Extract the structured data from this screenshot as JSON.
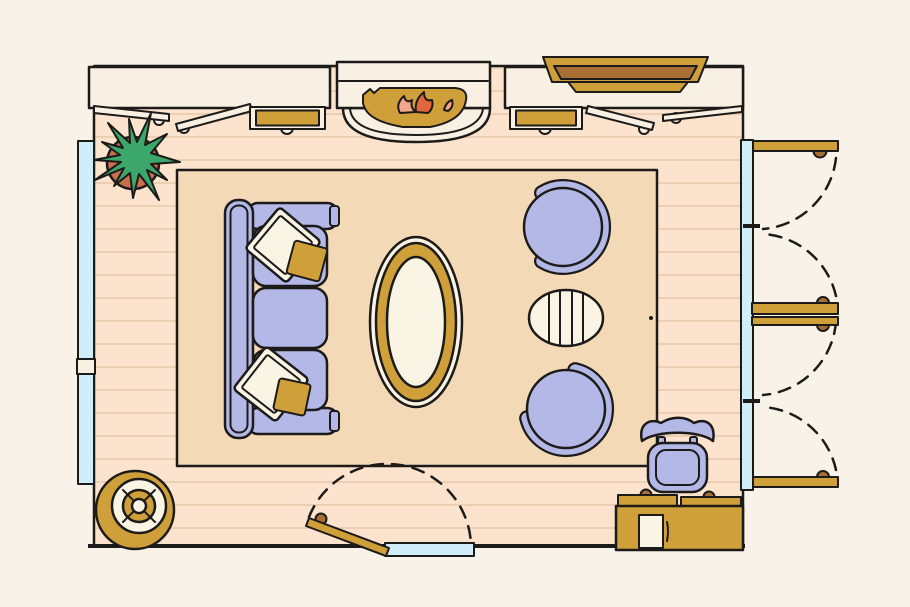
{
  "scene": {
    "type": "floor-plan-illustration",
    "room": "living-room",
    "items": [
      {
        "name": "wood-floor"
      },
      {
        "name": "area-rug"
      },
      {
        "name": "sofa",
        "pillows": 2
      },
      {
        "name": "throw-pillow-top"
      },
      {
        "name": "throw-pillow-bottom"
      },
      {
        "name": "oval-coffee-table"
      },
      {
        "name": "accent-chair-top"
      },
      {
        "name": "accent-chair-bottom"
      },
      {
        "name": "striped-ottoman"
      },
      {
        "name": "fireplace-with-fire"
      },
      {
        "name": "media-console-tv"
      },
      {
        "name": "side-cabinet-left"
      },
      {
        "name": "side-cabinet-right"
      },
      {
        "name": "open-casement-windows",
        "count": 4
      },
      {
        "name": "potted-plant"
      },
      {
        "name": "round-floor-lamp"
      },
      {
        "name": "desk-with-paper-and-pen"
      },
      {
        "name": "desk-chair"
      },
      {
        "name": "left-wall-windows",
        "count": 2
      },
      {
        "name": "french-patio-doors",
        "panels": 4
      },
      {
        "name": "interior-door-bottom"
      }
    ]
  },
  "colors": {
    "background": "#f8f2e8",
    "floor": "#fbe3cd",
    "floor_line": "#ecceb2",
    "rug": "#f4d9b7",
    "fixture_cream": "#f8f0e2",
    "pillow_cream": "#faf4e4",
    "periwinkle": "#b4b8e6",
    "outline": "#1d1b1a",
    "gold": "#cfa039",
    "brown": "#a96e33",
    "window_blue": "#cfeefa",
    "terracotta": "#c96f4e",
    "plant_green": "#3ca76a",
    "flame_orange": "#e2673d",
    "flame_light": "#f2a78c"
  }
}
